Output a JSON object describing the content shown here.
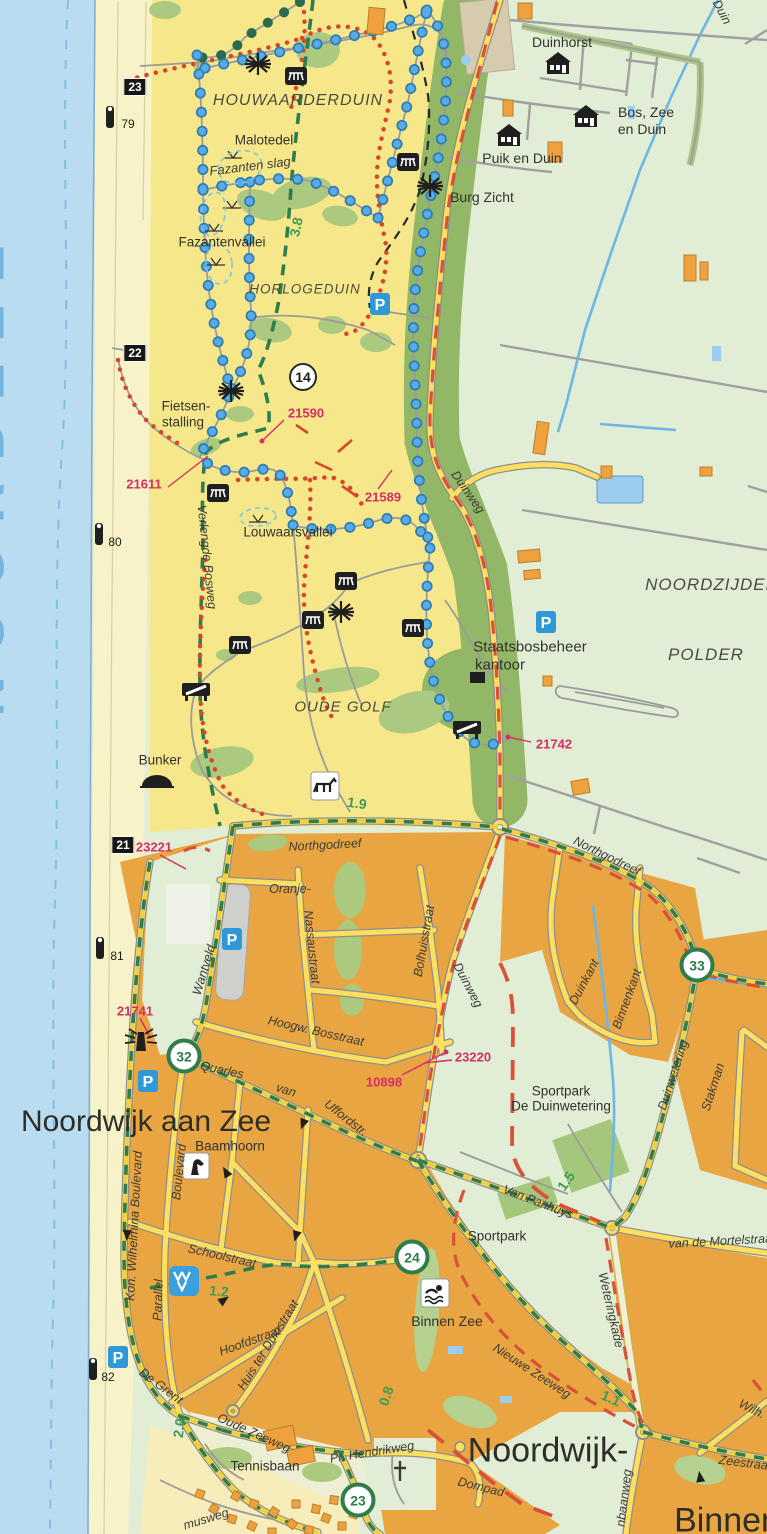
{
  "colors": {
    "sea": "#b9dcf1",
    "beach": "#f8f2c8",
    "dune": "#f6e88a",
    "forest": "#abc97f",
    "forest_dark": "#92b766",
    "polder": "#e2edd5",
    "urban": "#e8a542",
    "road_fill": "#ffe05e",
    "road_casing": "#8e8e8e",
    "route_green": "#2e7d4a",
    "boundary_red": "#d9513a",
    "node_magenta": "#d62e66",
    "trail_blue": "#58abe4",
    "trail_green_dots": "#2a6b50",
    "water_line": "#6cb7e8",
    "parking_blue": "#2f99d8"
  },
  "labels": {
    "noordzee": "NOORDZEE",
    "houwaarderduin": "HOUWAARDERDUIN",
    "malotedel": "Malotedel",
    "fazanten_slag": "Fazanten slag",
    "fazantenvallei": "Fazantenvallei",
    "horlogeduin": "HORLOGEDUIN",
    "fietsenstalling_1": "Fietsen-",
    "fietsenstalling_2": "stalling",
    "louwaarsvallei": "Louwaarsvallei",
    "verlengde_bosweg": "Verlengde Bosweg",
    "oude_golf": "OUDE GOLF",
    "bunker": "Bunker",
    "staatsbosbeheer_1": "Staatsbosbeheer",
    "staatsbosbeheer_2": "kantoor",
    "noordzijder": "NOORDZIJDER",
    "polder": "POLDER",
    "duinhorst": "Duinhorst",
    "bos_zee_1": "Bos, Zee",
    "bos_zee_2": "en Duin",
    "puik_en_duin": "Puik en Duin",
    "burg_zicht": "Burg Zicht",
    "duin_waterway": "Duin",
    "duinweg_n": "Duinweg",
    "duinweg_s": "Duinweg",
    "northgodreef_w": "Northgodreef",
    "northgodreef_e": "Northgodreef",
    "wantveld": "Wantveld",
    "oranje": "Oranje-",
    "nassaustraat": "Nassaustraat",
    "bolhuisstraat": "Bolhuisstraat",
    "hoogw_bosstraat": "Hoogw. Bosstraat",
    "quarles": "Quarles",
    "van": "van",
    "uffordstr": "Uffordstr.",
    "duinkant": "Duinkant",
    "binnenkant": "Binnenkant",
    "duinwetering": "Duinwetering",
    "stakman": "Stakman",
    "sportpark_dw_1": "Sportpark",
    "sportpark_dw_2": "De Duinwetering",
    "van_panhuys": "Van Panhuys",
    "sportpark": "Sportpark",
    "van_de_mortelstraat": "van de Mortelstraat",
    "weteringkade": "Weteringkade",
    "nieuwe_zeeweg": "Nieuwe Zeeweg",
    "wilh": "Wilh.",
    "zeestraat": "Zeestraat",
    "noordwijk_aan_zee": "Noordwijk aan Zee",
    "noordwijk_binnen_1": "Noordwijk-",
    "noordwijk_binnen_2": "Binnen",
    "binnen_zee": "Binnen Zee",
    "baamhoorn": "Baamhoorn",
    "kon_wilhelmina": "Kon. Wilhelmina Boulevard",
    "boulevard": "Boulevard",
    "parallel": "Parallel",
    "schoolstraat": "Schoolstraat",
    "hoofdstraat": "Hoofdstraat",
    "huis_ter_duinstraat": "Huis ter Duinstraat",
    "de_grent": "De Grent",
    "oude_zeeweg": "Oude Zeeweg",
    "pr_hendrikweg": "Pr. Hendrikweg",
    "dompad": "Dompad",
    "tennisbaan": "Tennisbaan",
    "musweg": "musweg",
    "lijnbaanweg": "nbaanweg"
  },
  "nodes": {
    "n21590": "21590",
    "n21611": "21611",
    "n21589": "21589",
    "n21742": "21742",
    "n23221": "23221",
    "n21741": "21741",
    "n10898": "10898",
    "n23220": "23220"
  },
  "distances": {
    "d1": "3.8",
    "d2": "1.9",
    "d3": "1.5",
    "d4": "1.2",
    "d5": "1.1",
    "d6": "0.8",
    "d7": "2.0"
  },
  "routes": {
    "r14": "14",
    "r32": "32",
    "r33": "33",
    "r24": "24",
    "r23": "23"
  },
  "km_boxes": {
    "k23": "23",
    "k22": "22",
    "k21": "21"
  },
  "beach_poles": {
    "p79": "79",
    "p80": "80",
    "p81": "81",
    "p82": "82"
  },
  "icons": {
    "parking": "P"
  }
}
